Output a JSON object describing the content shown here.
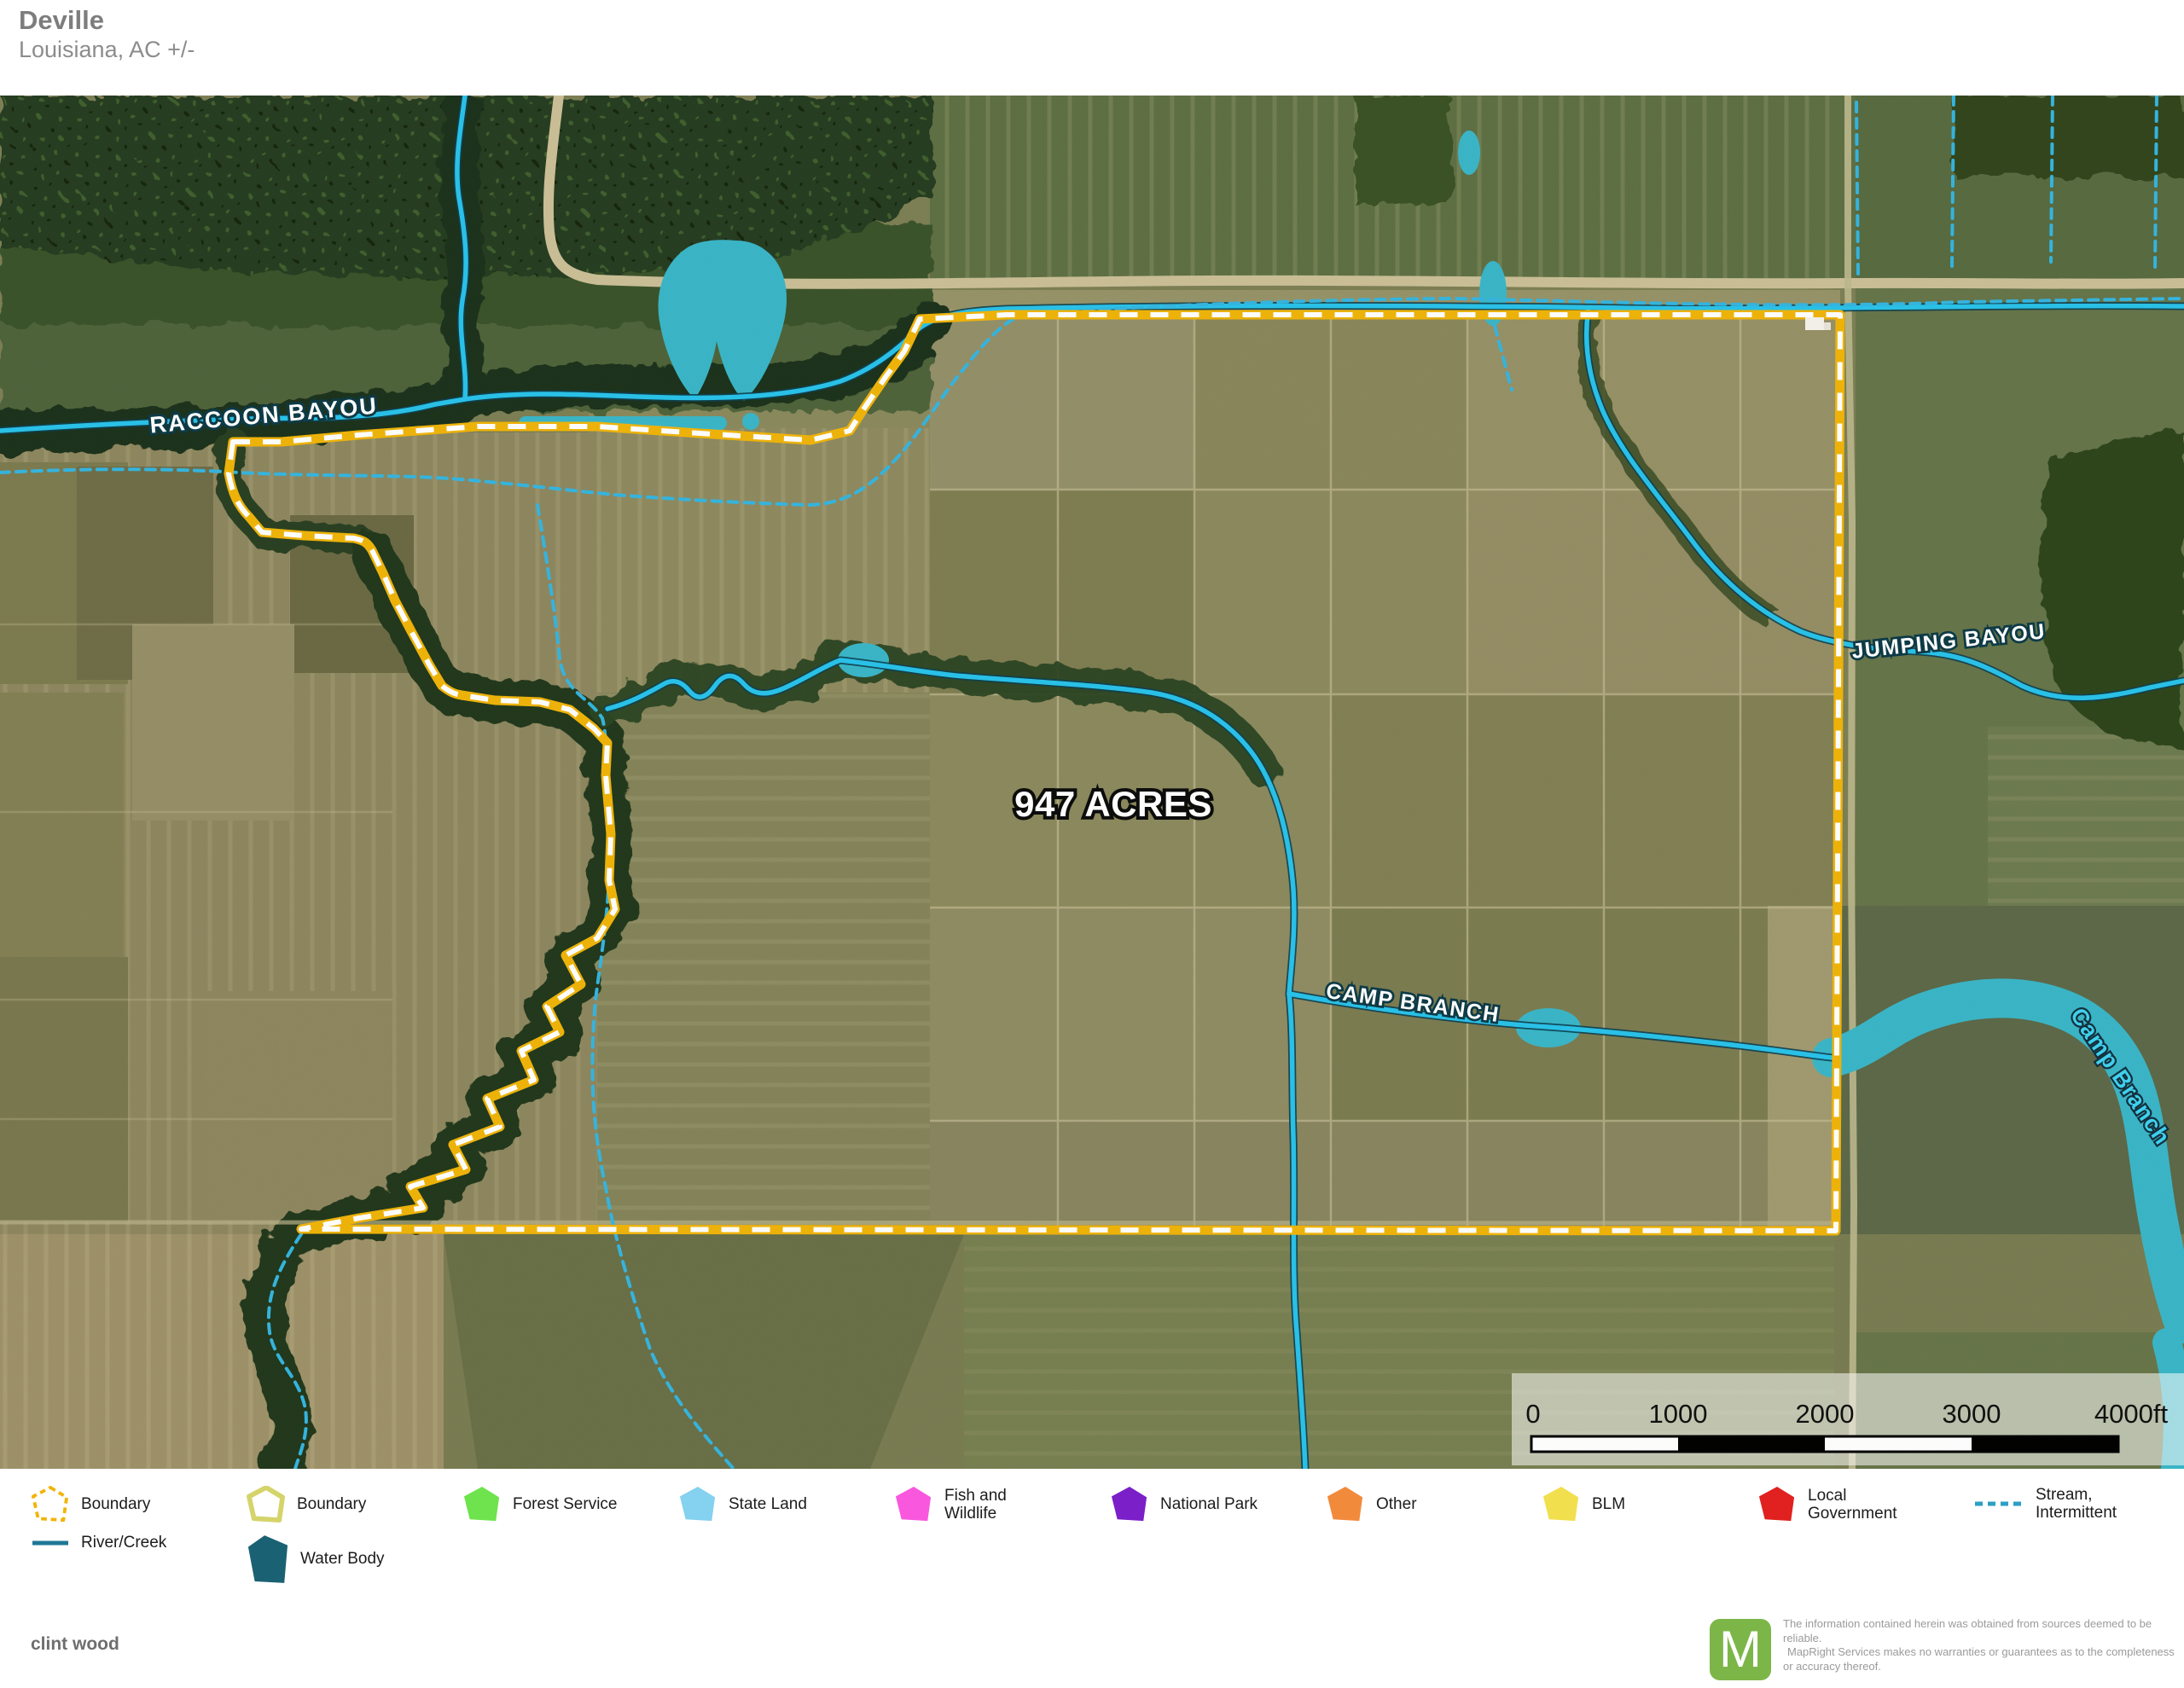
{
  "header": {
    "title": "Deville",
    "subtitle": "Louisiana,  AC +/-"
  },
  "map": {
    "area_label": "947 ACRES",
    "stream_labels": {
      "raccoon_bayou": "RACCOON BAYOU",
      "jumping_bayou": "JUMPING BAYOU",
      "camp_branch": "CAMP BRANCH",
      "camp_branch_river": "Camp Branch"
    },
    "scale_bar": {
      "ticks": [
        "0",
        "1000",
        "2000",
        "3000",
        "4000ft"
      ]
    }
  },
  "legend": {
    "items": [
      {
        "label": "Boundary"
      },
      {
        "label": "Boundary"
      },
      {
        "label": "Forest Service"
      },
      {
        "label": "State Land"
      },
      {
        "label": "Fish and Wildlife"
      },
      {
        "label": "National Park"
      },
      {
        "label": "Other"
      },
      {
        "label": "BLM"
      },
      {
        "label": "Local Government"
      },
      {
        "label": "Stream, Intermittent"
      },
      {
        "label": "River/Creek"
      },
      {
        "label": "Water Body"
      }
    ]
  },
  "colors": {
    "boundary_yellow": "#F0B409",
    "boundary_khaki": "#D5D46B",
    "forest_service": "#6FE34D",
    "state_land": "#84D1F0",
    "fish_wildlife": "#F957DE",
    "national_park": "#7B1FC9",
    "other_orange": "#F28A3C",
    "blm_yellow": "#F2DF4E",
    "local_government": "#E0211F",
    "stream_intermittent": "#2E9FC4",
    "river_creek": "#1F7796",
    "water_body": "#1A6173",
    "stream_cyan": "#29C2EA",
    "water_teal": "#3AB6C8",
    "logo_green": "#7CB648"
  },
  "footer": {
    "author": "clint wood",
    "logo_letter": "M",
    "disclaimer": [
      "The information contained herein was obtained from sources deemed to be reliable.",
      "MapRight Services makes no warranties or guarantees as to the completeness or accuracy thereof."
    ]
  }
}
